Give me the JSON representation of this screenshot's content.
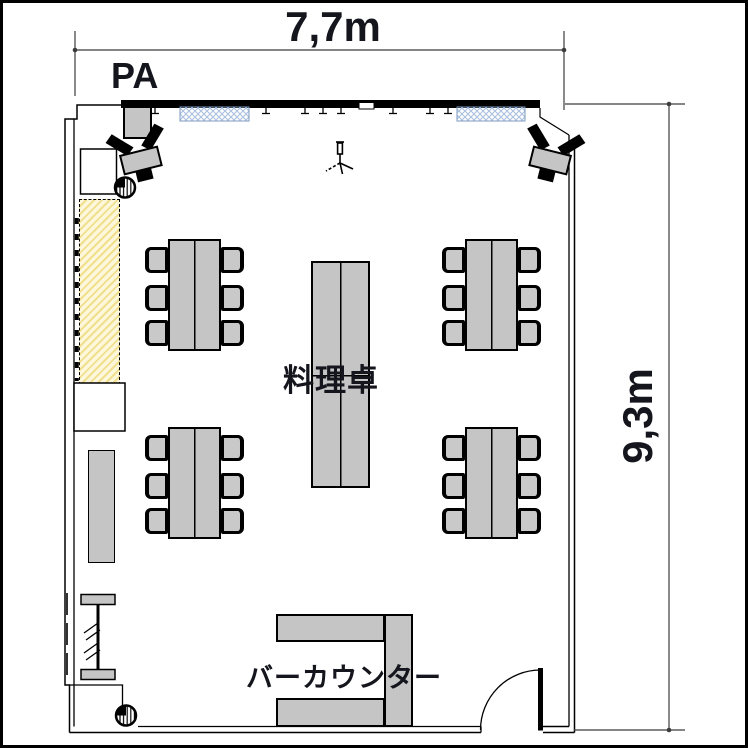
{
  "dimensions": {
    "width_label": "7,7m",
    "height_label": "9,3m"
  },
  "labels": {
    "pa": "PA",
    "cooking_table": "料理卓",
    "bar_counter": "バーカウンター"
  },
  "colors": {
    "furniture_fill": "#c5c5c5",
    "chair_fill": "#c9c9c9",
    "window_hatch": "#a9c0de",
    "floor_hatch_bg": "#fdf8dc",
    "floor_hatch_stripe": "#f1df8e",
    "wall": "#000000",
    "text": "#15151e"
  },
  "objects": {
    "dining_table_groups": 4,
    "chairs_per_dining_table": 6,
    "central_table_count": 1,
    "speaker_count": 2,
    "column_count": 2,
    "mic_stand_count": 1,
    "window_strip_count": 2,
    "door_count": 1
  }
}
